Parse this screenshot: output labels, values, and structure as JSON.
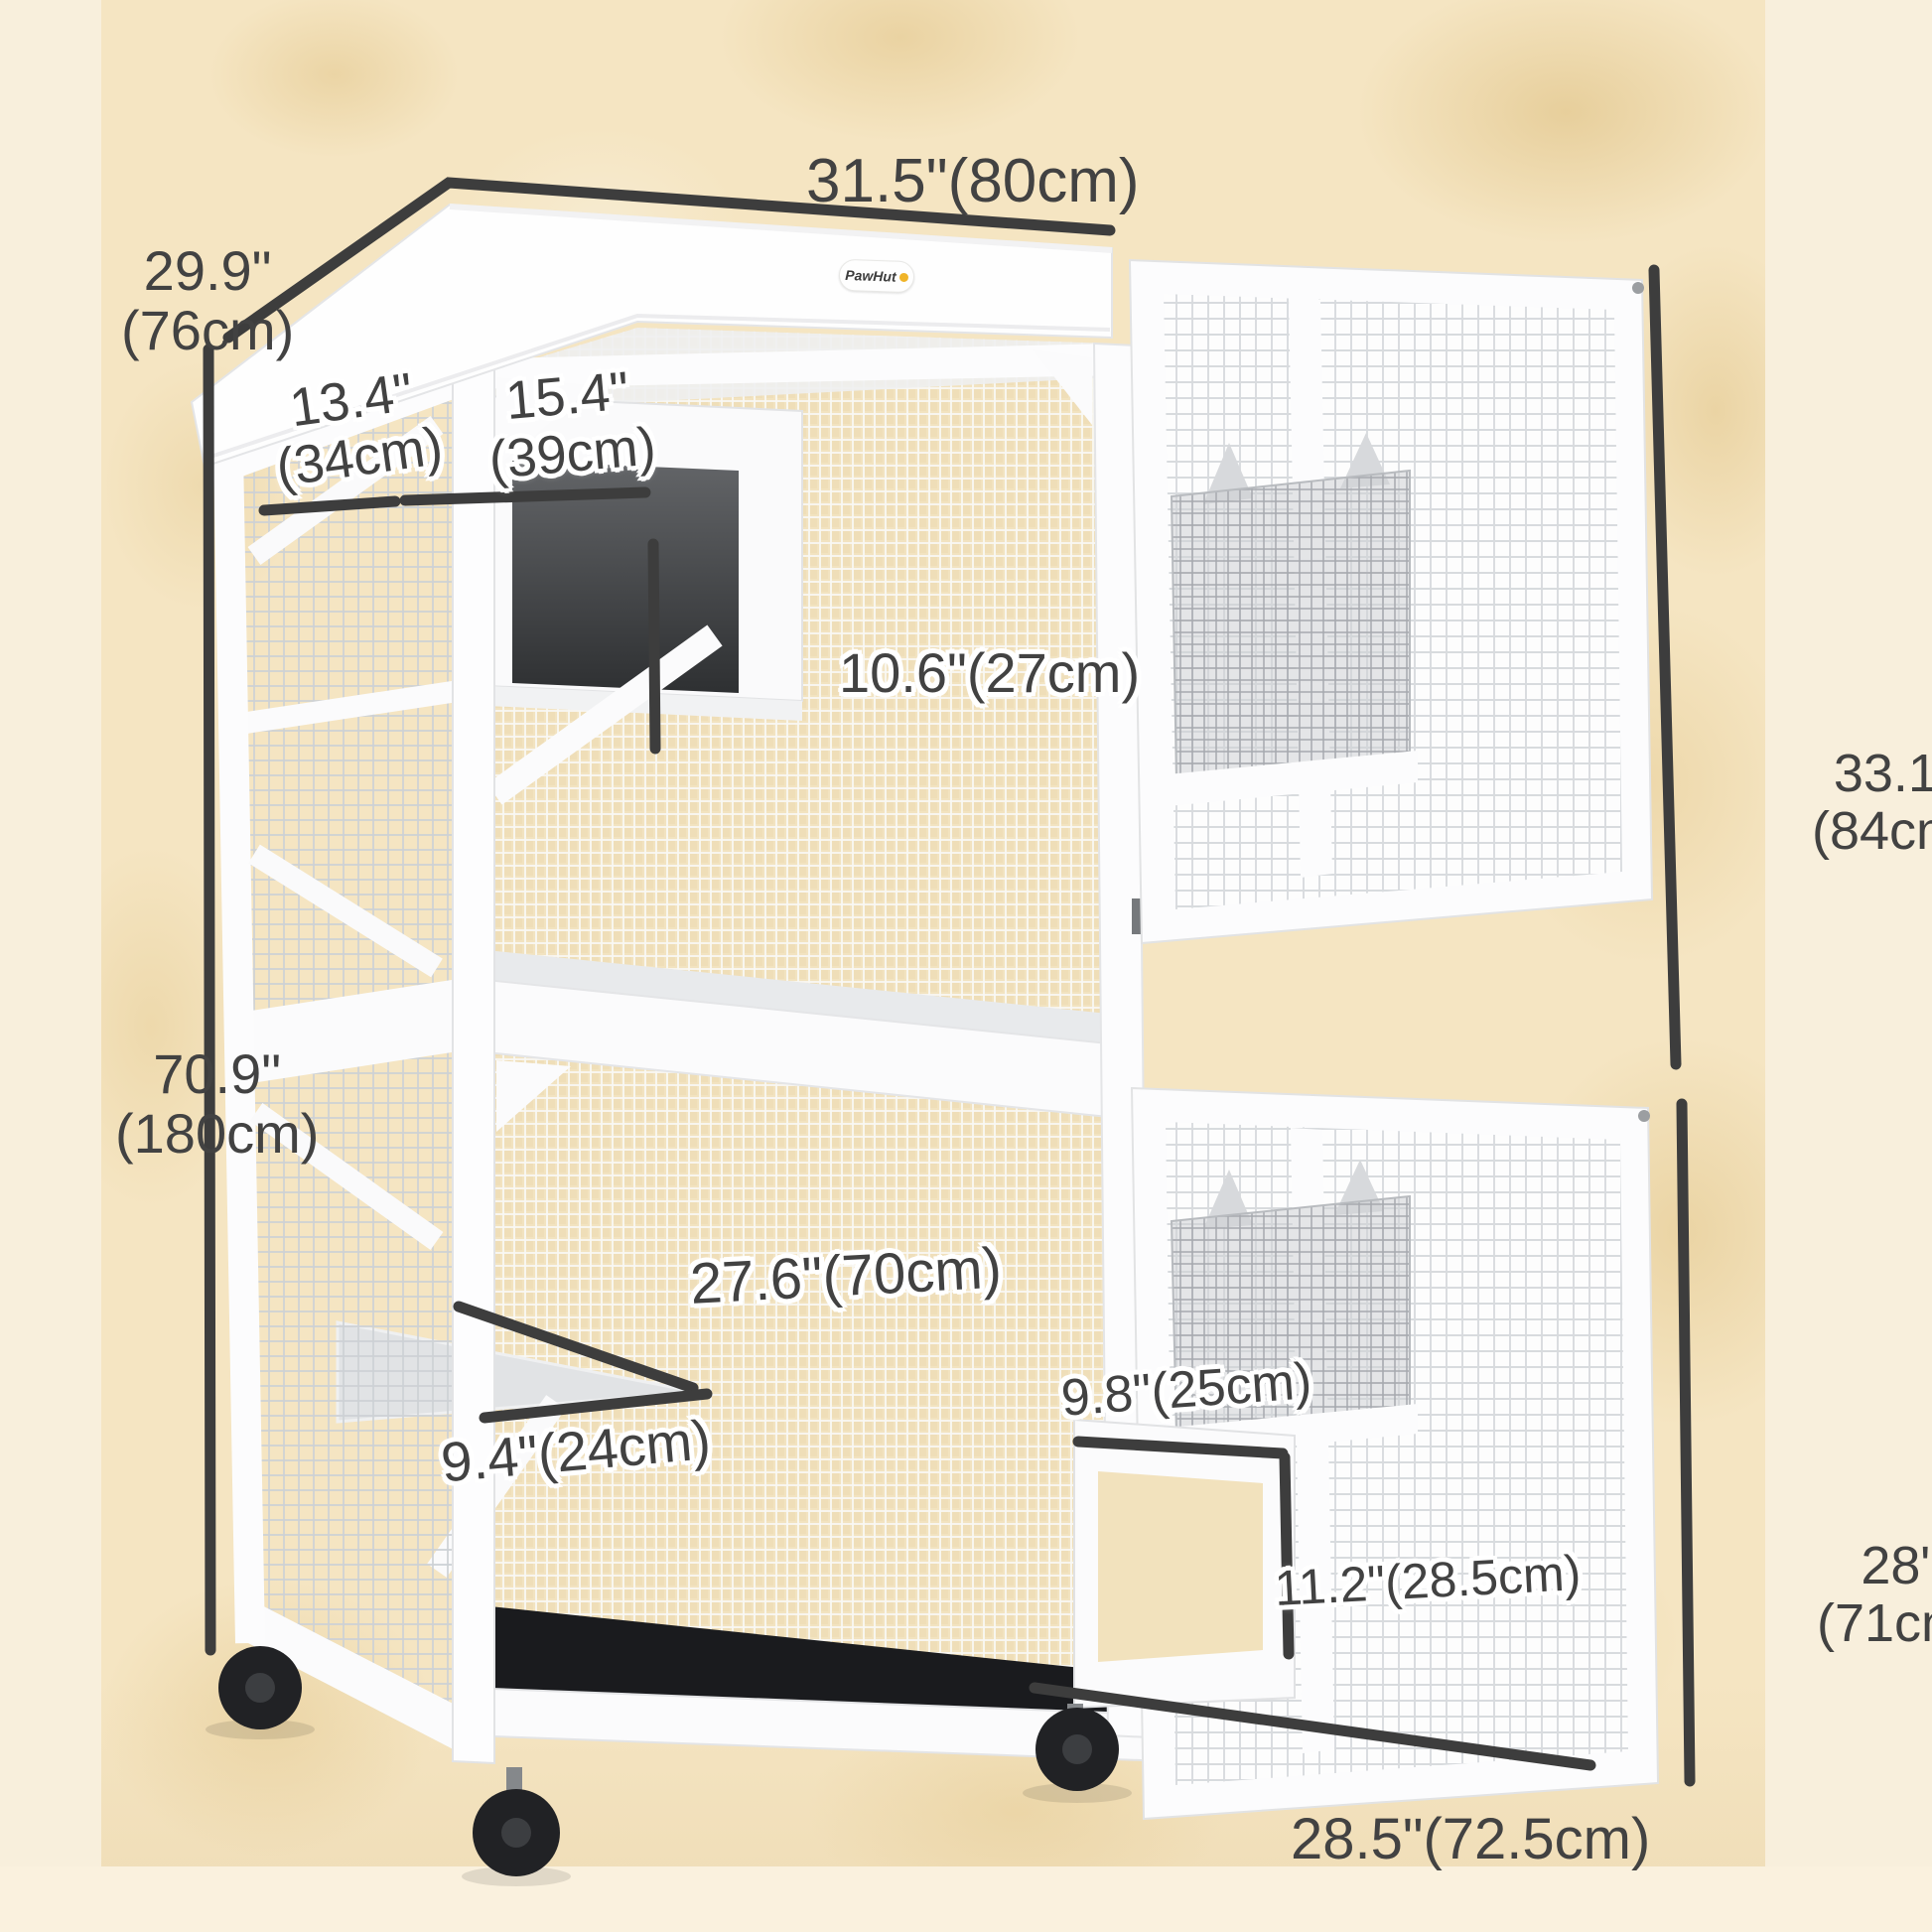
{
  "brand": {
    "logo_text": "PawHut"
  },
  "colors": {
    "background_wall": "#f5e5c2",
    "background_light": "#f8efdc",
    "dimension_line": "#3d3d3d",
    "label_text": "#424242",
    "frame_white": "#fcfcfd",
    "mesh_gray": "#ced2d6",
    "condo_interior_dark": "#37393c",
    "floor_black": "#1a1b1e",
    "caster_black": "#212225",
    "logo_yellow": "#f0b428"
  },
  "dims": {
    "top_width": {
      "text": "31.5\"(80cm)"
    },
    "depth": {
      "line1": "29.9\"",
      "line2": "(76cm)"
    },
    "roof_left_depth": {
      "line1": "13.4\"",
      "line2": "(34cm)"
    },
    "condo_width": {
      "line1": "15.4\"",
      "line2": "(39cm)"
    },
    "condo_door_height": {
      "text": "10.6\"(27cm)"
    },
    "total_height": {
      "line1": "70.9\"",
      "line2": "(180cm)"
    },
    "upper_door_height": {
      "line1": "33.1\"",
      "line2": "(84cm)"
    },
    "shelf_width": {
      "text": "27.6\"(70cm)"
    },
    "shelf_depth": {
      "text": "9.4\"(24cm)"
    },
    "cat_door_width": {
      "text": "9.8\"(25cm)"
    },
    "cat_door_height": {
      "text": "11.2\"(28.5cm)"
    },
    "lower_door_height": {
      "line1": "28\"",
      "line2": "(71cm)"
    },
    "bottom_width": {
      "text": "28.5\"(72.5cm)"
    }
  }
}
